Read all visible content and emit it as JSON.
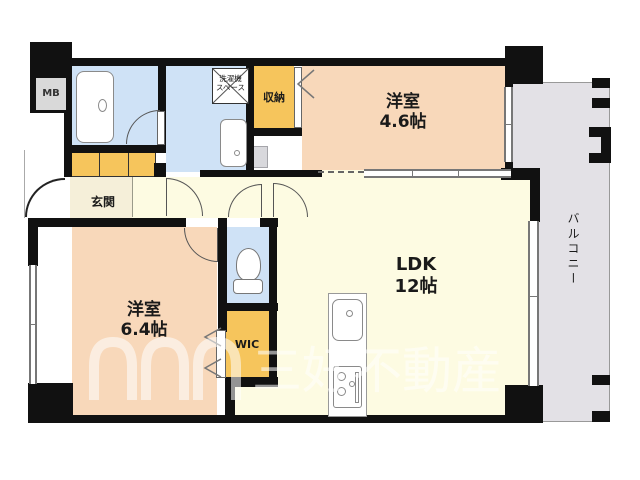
{
  "rooms": {
    "bedroom1": {
      "label": "洋室",
      "size": "4.6帖"
    },
    "bedroom2": {
      "label": "洋室",
      "size": "6.4帖"
    },
    "ldk": {
      "label": "LDK",
      "size": "12帖"
    },
    "closet": {
      "label": "収納"
    },
    "wic": {
      "label": "WIC"
    },
    "entrance": {
      "label": "玄関"
    },
    "balcony": {
      "label": "バルコニー"
    },
    "laundry": {
      "label_line1": "洗濯機",
      "label_line2": "スペース"
    },
    "meter_box": {
      "label": "MB"
    }
  },
  "watermark": {
    "text": "三好不動産"
  },
  "colors": {
    "wall": "#111111",
    "wet_room_blue": "#cfe2f6",
    "closet_orange": "#f6c55c",
    "bedroom_peach": "#f8d8ba",
    "entrance_cream": "#f5efd9",
    "ldk_yellow": "#fdfbe2",
    "balcony_gray": "#e3e1e6",
    "fixture_outline": "#8a8a8a"
  }
}
